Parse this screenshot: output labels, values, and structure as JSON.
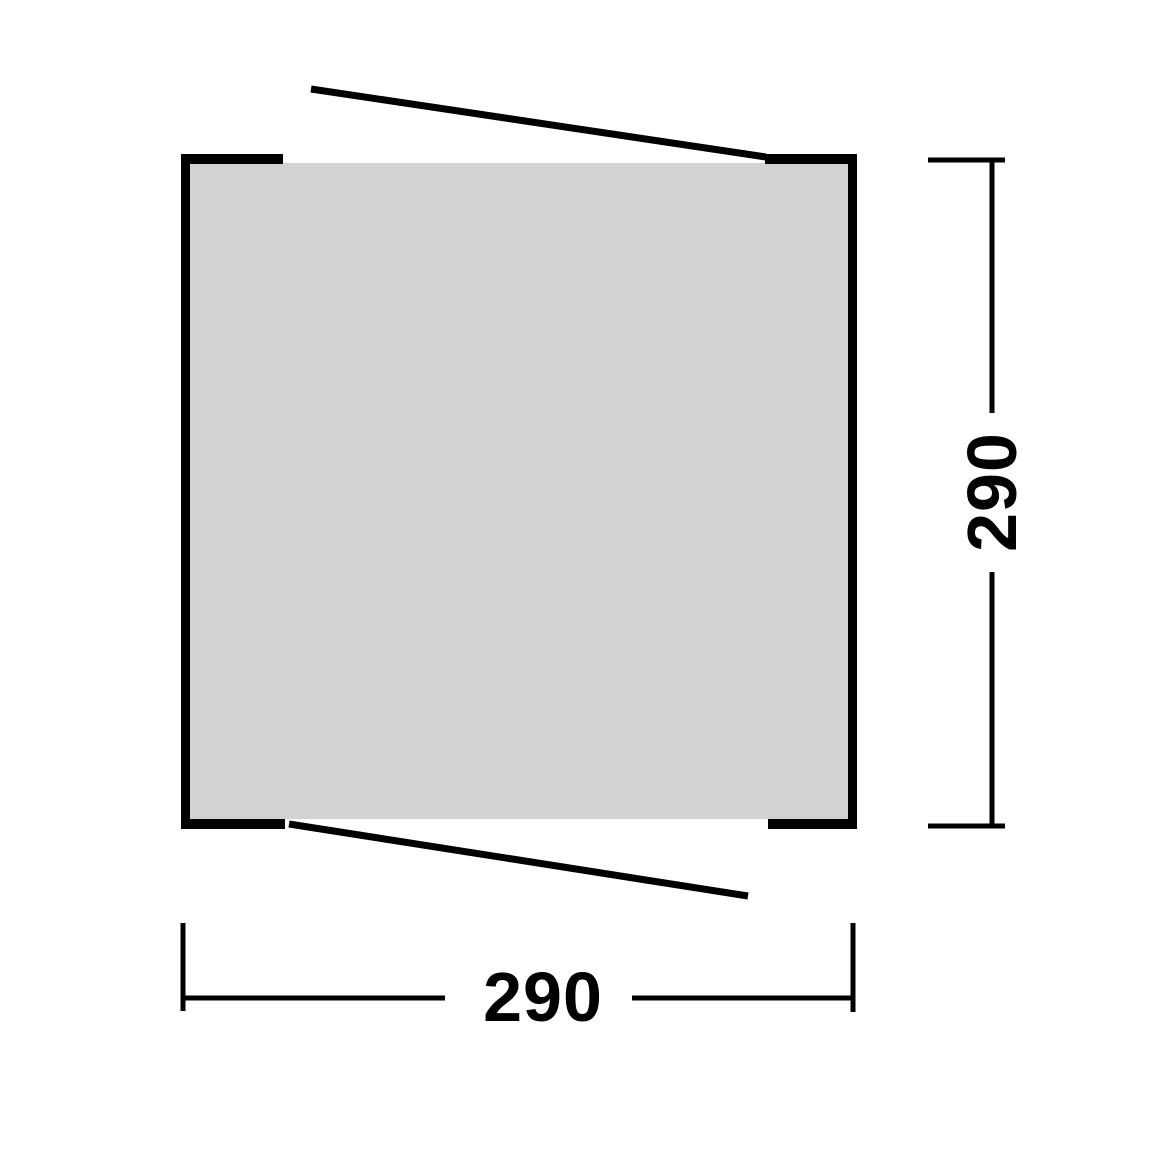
{
  "diagram": {
    "type": "floorplan-top-view",
    "shape": "square-footprint-with-openings",
    "dimensions": {
      "width_label": "290",
      "height_label": "290"
    },
    "colors": {
      "footprint_fill": "#d2d2d2",
      "line": "#000000",
      "background": "#ffffff"
    }
  }
}
